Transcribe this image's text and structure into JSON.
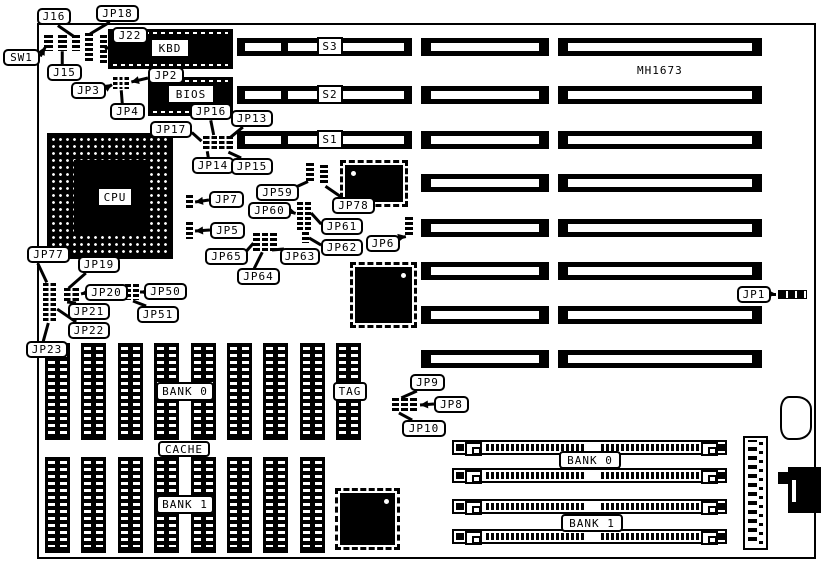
{
  "title": {
    "text": "MH1673",
    "x": 637,
    "y": 64
  },
  "colors": {
    "ink": "#000000",
    "paper": "#ffffff"
  },
  "board": {
    "x": 37,
    "y": 23,
    "w": 779,
    "h": 536
  },
  "slots": {
    "row_y": [
      38,
      86,
      131,
      174,
      219,
      262,
      306,
      350
    ],
    "left": {
      "x": 237,
      "w": 175,
      "h": 18,
      "rows": [
        0,
        1,
        2
      ],
      "stripes": [
        [
          8,
          36
        ],
        [
          51,
          116
        ]
      ],
      "labels": [
        "S3",
        "S2",
        "S1"
      ],
      "label_x": 317,
      "label_w": 26,
      "label_h": 19
    },
    "mid": {
      "x": 421,
      "w": 128,
      "h": 18
    },
    "right": {
      "x": 558,
      "w": 204,
      "h": 18
    }
  },
  "cpu": {
    "label": "CPU",
    "x": 47,
    "y": 133,
    "w": 126,
    "h": 126,
    "label_x": 99,
    "label_y": 189,
    "label_w": 32,
    "label_h": 16
  },
  "chips": [
    {
      "id": "kbd-chip",
      "label": "KBD",
      "x": 108,
      "y": 29,
      "w": 125,
      "h": 40,
      "label_x": 152,
      "label_y": 40,
      "label_w": 36,
      "label_h": 16
    },
    {
      "id": "bios-chip",
      "label": "BIOS",
      "x": 148,
      "y": 77,
      "w": 85,
      "h": 39,
      "label_x": 169,
      "label_y": 86,
      "label_w": 44,
      "label_h": 16
    }
  ],
  "qfp_chips": [
    {
      "id": "qfp-chip-a",
      "x": 340,
      "y": 160,
      "w": 68,
      "h": 47,
      "dot": "tl"
    },
    {
      "id": "qfp-chip-b",
      "x": 350,
      "y": 262,
      "w": 67,
      "h": 66,
      "dot": "tr"
    },
    {
      "id": "qfp-chip-c",
      "x": 335,
      "y": 488,
      "w": 65,
      "h": 62,
      "dot": "tr"
    }
  ],
  "dip_rows": [
    {
      "id": "cache-row-top",
      "x0": 45,
      "pitch": 36.4,
      "count": 9,
      "y": 343,
      "w": 25,
      "h": 97
    },
    {
      "id": "cache-row-bottom",
      "x0": 45,
      "pitch": 36.4,
      "count": 8,
      "y": 457,
      "w": 25,
      "h": 96
    }
  ],
  "jumpers": [
    {
      "id": "sw1-switch",
      "x": 44,
      "y": 35,
      "w": 9,
      "h": 16,
      "cols": 1
    },
    {
      "id": "j15-header",
      "x": 58,
      "y": 35,
      "w": 9,
      "h": 16,
      "cols": 1
    },
    {
      "id": "j16-header",
      "x": 72,
      "y": 35,
      "w": 8,
      "h": 16,
      "cols": 1
    },
    {
      "id": "jp18-header",
      "x": 85,
      "y": 33,
      "w": 8,
      "h": 28,
      "cols": 1
    },
    {
      "id": "j22-header",
      "x": 100,
      "y": 35,
      "w": 7,
      "h": 28,
      "cols": 1
    },
    {
      "id": "jp2-jp3-jp4-block",
      "x": 113,
      "y": 77,
      "w": 16,
      "h": 12,
      "cols": 3
    },
    {
      "id": "jp17-block",
      "x": 203,
      "y": 136,
      "w": 30,
      "h": 15,
      "cols": 4
    },
    {
      "id": "jp7-jumper",
      "x": 186,
      "y": 195,
      "w": 7,
      "h": 15,
      "cols": 1
    },
    {
      "id": "jp5-jumper",
      "x": 186,
      "y": 222,
      "w": 7,
      "h": 17,
      "cols": 1
    },
    {
      "id": "jp59-jumper-a",
      "x": 306,
      "y": 163,
      "w": 8,
      "h": 20,
      "cols": 1
    },
    {
      "id": "jp59-jumper-b",
      "x": 320,
      "y": 165,
      "w": 8,
      "h": 20,
      "cols": 1
    },
    {
      "id": "jp60-block",
      "x": 297,
      "y": 202,
      "w": 14,
      "h": 28,
      "cols": 2
    },
    {
      "id": "jp62-jumper",
      "x": 302,
      "y": 232,
      "w": 7,
      "h": 11,
      "cols": 1
    },
    {
      "id": "jp63-jp64-jp65-block",
      "x": 253,
      "y": 233,
      "w": 24,
      "h": 18,
      "cols": 3
    },
    {
      "id": "jp6-jumper",
      "x": 405,
      "y": 217,
      "w": 8,
      "h": 20,
      "cols": 1
    },
    {
      "id": "jp77-header",
      "x": 43,
      "y": 283,
      "w": 13,
      "h": 39,
      "cols": 2
    },
    {
      "id": "jp19-block",
      "x": 64,
      "y": 288,
      "w": 15,
      "h": 15,
      "cols": 2
    },
    {
      "id": "jp50-block",
      "x": 125,
      "y": 284,
      "w": 14,
      "h": 16,
      "cols": 2
    },
    {
      "id": "jp9-jumper",
      "x": 392,
      "y": 398,
      "w": 7,
      "h": 14,
      "cols": 1
    },
    {
      "id": "jp8-jumper",
      "x": 401,
      "y": 398,
      "w": 7,
      "h": 14,
      "cols": 1
    },
    {
      "id": "jp10-jumper",
      "x": 410,
      "y": 398,
      "w": 7,
      "h": 14,
      "cols": 1
    }
  ],
  "simms": {
    "x": 452,
    "w": 275,
    "h": 15,
    "ys": [
      440,
      468,
      499,
      529
    ]
  },
  "connectors": {
    "power": {
      "x": 743,
      "y": 436,
      "w": 25,
      "h": 114
    },
    "blob": {
      "x": 780,
      "y": 396,
      "w": 32,
      "h": 44
    },
    "din": {
      "x": 788,
      "y": 467,
      "w": 33,
      "h": 46
    },
    "din_notch": {
      "x": 778,
      "y": 472,
      "w": 11,
      "h": 12
    },
    "din_slot": {
      "x": 792,
      "y": 480,
      "w": 4,
      "h": 22
    },
    "jp1_conn": {
      "x": 778,
      "y": 290,
      "w": 29,
      "h": 9
    }
  },
  "area_labels": [
    {
      "id": "cache-bank0-label",
      "label": "BANK 0",
      "x": 156,
      "y": 382,
      "w": 58,
      "h": 19
    },
    {
      "id": "tag-label",
      "label": "TAG",
      "x": 333,
      "y": 382,
      "w": 34,
      "h": 19
    },
    {
      "id": "cache-label",
      "label": "CACHE",
      "x": 158,
      "y": 441,
      "w": 52,
      "h": 16
    },
    {
      "id": "cache-bank1-label",
      "label": "BANK 1",
      "x": 156,
      "y": 495,
      "w": 58,
      "h": 19
    },
    {
      "id": "simm-bank0-label",
      "label": "BANK 0",
      "x": 559,
      "y": 451,
      "w": 62,
      "h": 18
    },
    {
      "id": "simm-bank1-label",
      "label": "BANK 1",
      "x": 561,
      "y": 514,
      "w": 62,
      "h": 18
    }
  ],
  "callouts": [
    {
      "id": "j16",
      "label": "J16",
      "box": [
        37,
        8,
        34
      ],
      "leader": [
        58,
        25,
        74,
        36
      ],
      "arrow": false
    },
    {
      "id": "jp18",
      "label": "JP18",
      "box": [
        96,
        5,
        43
      ],
      "leader": [
        110,
        22,
        90,
        34
      ],
      "arrow": false
    },
    {
      "id": "j22",
      "label": "J22",
      "box": [
        112,
        27,
        36
      ],
      "leader": [
        117,
        44,
        105,
        49
      ],
      "arrow": false
    },
    {
      "id": "sw1",
      "label": "SW1",
      "box": [
        3,
        49,
        37
      ],
      "leader": [
        40,
        56,
        45,
        47
      ],
      "arrow": true
    },
    {
      "id": "j15",
      "label": "J15",
      "box": [
        47,
        64,
        35
      ],
      "leader": [
        62,
        64,
        62,
        51
      ],
      "arrow": false
    },
    {
      "id": "jp3",
      "label": "JP3",
      "box": [
        71,
        82,
        35
      ],
      "leader": [
        106,
        88,
        112,
        84
      ],
      "arrow": true
    },
    {
      "id": "jp2",
      "label": "JP2",
      "box": [
        148,
        67,
        36
      ],
      "leader": [
        148,
        78,
        131,
        82
      ],
      "arrow": true
    },
    {
      "id": "jp4",
      "label": "JP4",
      "box": [
        110,
        103,
        35
      ],
      "leader": [
        122,
        103,
        121,
        90
      ],
      "arrow": false
    },
    {
      "id": "jp16",
      "label": "JP16",
      "box": [
        190,
        103,
        42
      ],
      "leader": [
        211,
        120,
        214,
        135
      ],
      "arrow": false
    },
    {
      "id": "jp13",
      "label": "JP13",
      "box": [
        231,
        110,
        42
      ],
      "leader": [
        243,
        127,
        231,
        137
      ],
      "arrow": false
    },
    {
      "id": "jp17",
      "label": "JP17",
      "box": [
        150,
        121,
        42
      ],
      "leader": [
        192,
        132,
        202,
        141
      ],
      "arrow": false
    },
    {
      "id": "jp14",
      "label": "JP14",
      "box": [
        192,
        157,
        42
      ],
      "leader": [
        208,
        157,
        207,
        151
      ],
      "arrow": false
    },
    {
      "id": "jp15",
      "label": "JP15",
      "box": [
        231,
        158,
        42
      ],
      "leader": [
        241,
        158,
        228,
        152
      ],
      "arrow": false
    },
    {
      "id": "jp7",
      "label": "JP7",
      "box": [
        209,
        191,
        35
      ],
      "leader": [
        209,
        200,
        195,
        202
      ],
      "arrow": true
    },
    {
      "id": "jp5",
      "label": "JP5",
      "box": [
        210,
        222,
        35
      ],
      "leader": [
        210,
        230,
        195,
        231
      ],
      "arrow": true
    },
    {
      "id": "jp59",
      "label": "JP59",
      "box": [
        256,
        184,
        43
      ],
      "leader": [
        297,
        186,
        308,
        181
      ],
      "arrow": false
    },
    {
      "id": "jp78",
      "label": "JP78",
      "box": [
        332,
        197,
        43
      ],
      "leader": [
        341,
        197,
        325,
        186
      ],
      "arrow": false
    },
    {
      "id": "jp60",
      "label": "JP60",
      "box": [
        248,
        202,
        43
      ],
      "leader": [
        289,
        211,
        296,
        213
      ],
      "arrow": true
    },
    {
      "id": "jp61",
      "label": "JP61",
      "box": [
        321,
        218,
        42
      ],
      "leader": [
        321,
        224,
        311,
        213
      ],
      "arrow": false
    },
    {
      "id": "jp62",
      "label": "JP62",
      "box": [
        321,
        239,
        42
      ],
      "leader": [
        321,
        245,
        309,
        238
      ],
      "arrow": false
    },
    {
      "id": "jp65",
      "label": "JP65",
      "box": [
        205,
        248,
        43
      ],
      "leader": [
        246,
        251,
        253,
        243
      ],
      "arrow": false
    },
    {
      "id": "jp63",
      "label": "JP63",
      "box": [
        280,
        248,
        40
      ],
      "leader": [
        284,
        249,
        272,
        250
      ],
      "arrow": false
    },
    {
      "id": "jp64",
      "label": "JP64",
      "box": [
        237,
        268,
        43
      ],
      "leader": [
        254,
        268,
        262,
        252
      ],
      "arrow": false
    },
    {
      "id": "jp6",
      "label": "JP6",
      "box": [
        366,
        235,
        34
      ],
      "leader": [
        397,
        238,
        406,
        236
      ],
      "arrow": true
    },
    {
      "id": "jp77",
      "label": "JP77",
      "box": [
        27,
        246,
        43
      ],
      "leader": [
        38,
        263,
        47,
        282
      ],
      "arrow": false
    },
    {
      "id": "jp19",
      "label": "JP19",
      "box": [
        78,
        256,
        42
      ],
      "leader": [
        86,
        273,
        69,
        288
      ],
      "arrow": false
    },
    {
      "id": "jp20",
      "label": "JP20",
      "box": [
        85,
        284,
        43
      ],
      "leader": [
        85,
        293,
        81,
        294
      ],
      "arrow": true
    },
    {
      "id": "jp21",
      "label": "JP21",
      "box": [
        68,
        303,
        42
      ],
      "leader": [
        76,
        303,
        67,
        302
      ],
      "arrow": false
    },
    {
      "id": "jp22",
      "label": "JP22",
      "box": [
        68,
        322,
        42
      ],
      "leader": [
        76,
        322,
        57,
        309
      ],
      "arrow": false
    },
    {
      "id": "jp23",
      "label": "JP23",
      "box": [
        26,
        341,
        42
      ],
      "leader": [
        43,
        341,
        48,
        323
      ],
      "arrow": false
    },
    {
      "id": "jp50",
      "label": "JP50",
      "box": [
        144,
        283,
        43
      ],
      "leader": [
        144,
        292,
        140,
        292
      ],
      "arrow": true
    },
    {
      "id": "jp51",
      "label": "JP51",
      "box": [
        137,
        306,
        42
      ],
      "leader": [
        146,
        306,
        133,
        301
      ],
      "arrow": false
    },
    {
      "id": "jp9",
      "label": "JP9",
      "box": [
        410,
        374,
        35
      ],
      "leader": [
        417,
        391,
        401,
        398
      ],
      "arrow": false
    },
    {
      "id": "jp8",
      "label": "JP8",
      "box": [
        434,
        396,
        35
      ],
      "leader": [
        434,
        404,
        420,
        405
      ],
      "arrow": true
    },
    {
      "id": "jp10",
      "label": "JP10",
      "box": [
        402,
        420,
        44
      ],
      "leader": [
        412,
        420,
        399,
        413
      ],
      "arrow": false
    },
    {
      "id": "jp1",
      "label": "JP1",
      "box": [
        737,
        286,
        34
      ],
      "leader": [
        771,
        294,
        776,
        294
      ],
      "arrow": true
    }
  ]
}
